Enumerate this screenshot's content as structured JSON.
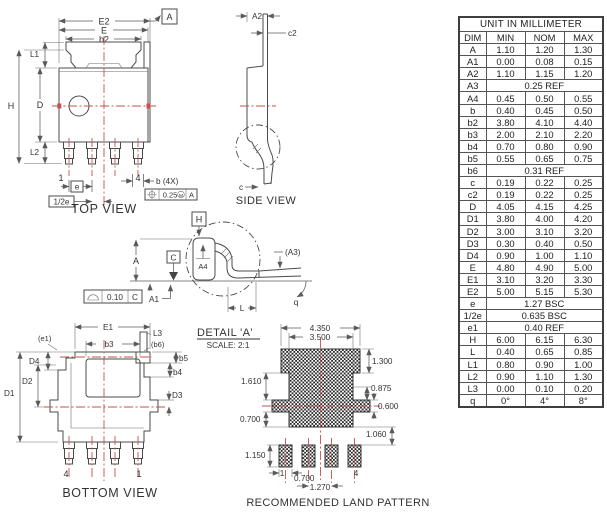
{
  "drawing": {
    "views": {
      "top_label": "TOP VIEW",
      "side_label": "SIDE VIEW",
      "bottom_label": "BOTTOM VIEW",
      "land_label": "RECOMMENDED LAND PATTERN",
      "detail_title": "DETAIL 'A'",
      "detail_scale": "SCALE: 2:1"
    },
    "top": {
      "E2": "E2",
      "E": "E",
      "b2": "b2",
      "L1": "L1",
      "H": "H",
      "D": "D",
      "L2": "L2",
      "pin1": "1",
      "pin4": "4",
      "pitch": "e",
      "half_pitch": "1/2e",
      "b_4x": "b (4X)",
      "datum_a": "A",
      "datum_h": "H",
      "pos_tol": "0.25",
      "pos_mod": "M",
      "pos_datum": "A"
    },
    "side": {
      "A2": "A2",
      "c2": "c2",
      "c": "c"
    },
    "front": {
      "A": "A",
      "A1": "A1",
      "A4": "A4",
      "A3": "(A3)",
      "q": "q",
      "L": "L",
      "datum_c": "C",
      "flat_tol": "0.10",
      "flat_datum": "C"
    },
    "bottom": {
      "E1": "E1",
      "e1": "(e1)",
      "b3": "b3",
      "L3": "L3",
      "b6": "(b6)",
      "b5": "b5",
      "b4": "b4",
      "D4": "D4",
      "D2": "D2",
      "D1": "D1",
      "D3": "D3",
      "pin4": "4",
      "pin1": "1"
    },
    "land": {
      "w_outer": "4.350",
      "w_inner": "3.500",
      "h_top": "1.300",
      "h_mid": "1.610",
      "h_step": "0.875",
      "h_bar": "0.600",
      "h_bottom": "0.700",
      "gap": "1.060",
      "pad_h": "1.150",
      "pad_w": "0.700",
      "pitch": "1.270",
      "pin1": "1",
      "pin4": "4"
    }
  },
  "table": {
    "title": "UNIT IN MILLIMETER",
    "headers": [
      "DIM",
      "MIN",
      "NOM",
      "MAX"
    ],
    "rows": [
      {
        "dim": "A",
        "min": "1.10",
        "nom": "1.20",
        "max": "1.30"
      },
      {
        "dim": "A1",
        "min": "0.00",
        "nom": "0.08",
        "max": "0.15"
      },
      {
        "dim": "A2",
        "min": "1.10",
        "nom": "1.15",
        "max": "1.20"
      },
      {
        "dim": "A3",
        "span": "0.25 REF"
      },
      {
        "dim": "A4",
        "min": "0.45",
        "nom": "0.50",
        "max": "0.55"
      },
      {
        "dim": "b",
        "min": "0.40",
        "nom": "0.45",
        "max": "0.50"
      },
      {
        "dim": "b2",
        "min": "3.80",
        "nom": "4.10",
        "max": "4.40"
      },
      {
        "dim": "b3",
        "min": "2.00",
        "nom": "2.10",
        "max": "2.20"
      },
      {
        "dim": "b4",
        "min": "0.70",
        "nom": "0.80",
        "max": "0.90"
      },
      {
        "dim": "b5",
        "min": "0.55",
        "nom": "0.65",
        "max": "0.75"
      },
      {
        "dim": "b6",
        "span": "0.31 REF"
      },
      {
        "dim": "c",
        "min": "0.19",
        "nom": "0.22",
        "max": "0.25"
      },
      {
        "dim": "c2",
        "min": "0.19",
        "nom": "0.22",
        "max": "0.25"
      },
      {
        "dim": "D",
        "min": "4.05",
        "nom": "4.15",
        "max": "4.25"
      },
      {
        "dim": "D1",
        "min": "3.80",
        "nom": "4.00",
        "max": "4.20"
      },
      {
        "dim": "D2",
        "min": "3.00",
        "nom": "3.10",
        "max": "3.20"
      },
      {
        "dim": "D3",
        "min": "0.30",
        "nom": "0.40",
        "max": "0.50"
      },
      {
        "dim": "D4",
        "min": "0.90",
        "nom": "1.00",
        "max": "1.10"
      },
      {
        "dim": "E",
        "min": "4.80",
        "nom": "4.90",
        "max": "5.00"
      },
      {
        "dim": "E1",
        "min": "3.10",
        "nom": "3.20",
        "max": "3.30"
      },
      {
        "dim": "E2",
        "min": "5.00",
        "nom": "5.15",
        "max": "5.30"
      },
      {
        "dim": "e",
        "span": "1.27 BSC"
      },
      {
        "dim": "1/2e",
        "span": "0.635 BSC"
      },
      {
        "dim": "e1",
        "span": "0.40 REF"
      },
      {
        "dim": "H",
        "min": "6.00",
        "nom": "6.15",
        "max": "6.30"
      },
      {
        "dim": "L",
        "min": "0.40",
        "nom": "0.65",
        "max": "0.85"
      },
      {
        "dim": "L1",
        "min": "0.80",
        "nom": "0.90",
        "max": "1.00"
      },
      {
        "dim": "L2",
        "min": "0.90",
        "nom": "1.10",
        "max": "1.30"
      },
      {
        "dim": "L3",
        "min": "0.00",
        "nom": "0.10",
        "max": "0.20"
      },
      {
        "dim": "q",
        "min": "0°",
        "nom": "4°",
        "max": "8°"
      }
    ]
  },
  "colors": {
    "centerline_red": "#c0534f",
    "drawing_line": "#4b4b4b",
    "text": "#333333",
    "hatch": "#2b2b2b"
  }
}
